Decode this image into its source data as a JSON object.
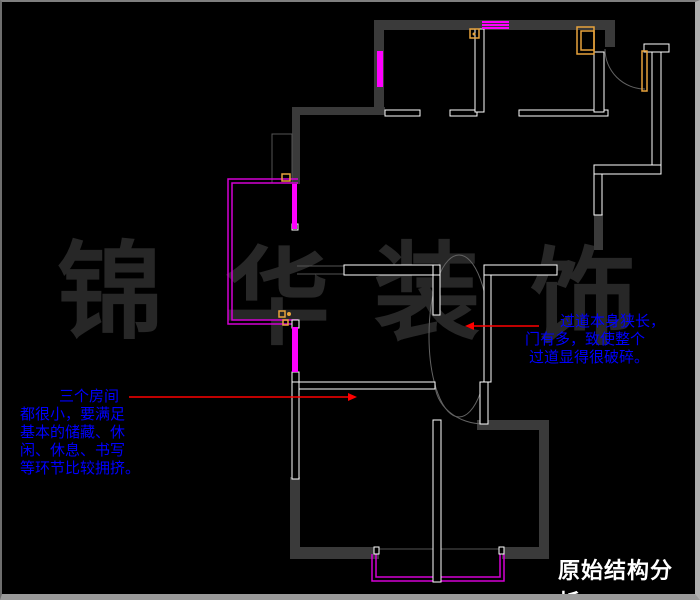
{
  "title": "原始结构分析",
  "watermark": {
    "chars": [
      "锦",
      "华",
      "装",
      "饰"
    ]
  },
  "annotations": {
    "left": {
      "lines": [
        "三个房间",
        "都很小，要满足",
        "基本的储藏、休",
        "闲、休息、书写",
        "等环节比较拥挤。"
      ]
    },
    "right": {
      "lines": [
        "过道本身狭长，",
        "门有多，致使整个",
        "过道显得很破碎。"
      ]
    }
  },
  "colors": {
    "background": "#000000",
    "wall_dark": "#3a3a3a",
    "wall_white": "#ffffff",
    "line_gray": "#555555",
    "arc_gray": "#636363",
    "window_magenta": "#ff00ff",
    "outline_magenta": "#d400d4",
    "fixture_orange": "#e8a33c",
    "leader_red": "#ff0000",
    "annotation_blue": "#0000ff",
    "title_white": "#ffffff",
    "watermark_gray": "#272727"
  },
  "floor_plan": {
    "dark_walls": [
      [
        372,
        18,
        241,
        10
      ],
      [
        372,
        18,
        10,
        95
      ],
      [
        290,
        105,
        93,
        8
      ],
      [
        290,
        105,
        8,
        77
      ],
      [
        603,
        28,
        10,
        17
      ],
      [
        592,
        212,
        9,
        36
      ],
      [
        288,
        475,
        10,
        80
      ],
      [
        288,
        545,
        89,
        12
      ],
      [
        475,
        418,
        72,
        10
      ],
      [
        537,
        418,
        10,
        134
      ],
      [
        500,
        545,
        47,
        12
      ]
    ],
    "white_walls": [
      [
        383,
        108,
        35,
        6
      ],
      [
        448,
        108,
        27,
        6
      ],
      [
        473,
        27,
        9,
        83
      ],
      [
        517,
        108,
        89,
        6
      ],
      [
        592,
        50,
        10,
        60
      ],
      [
        642,
        42,
        25,
        8
      ],
      [
        650,
        50,
        9,
        113
      ],
      [
        592,
        163,
        67,
        9
      ],
      [
        592,
        172,
        8,
        41
      ],
      [
        342,
        263,
        91,
        10
      ],
      [
        431,
        263,
        7,
        19
      ],
      [
        482,
        263,
        73,
        10
      ],
      [
        431,
        273,
        7,
        40
      ],
      [
        482,
        273,
        7,
        107
      ],
      [
        478,
        380,
        8,
        42
      ],
      [
        297,
        380,
        136,
        7
      ],
      [
        290,
        380,
        7,
        97
      ],
      [
        290,
        318,
        7,
        8
      ],
      [
        290,
        370,
        7,
        10
      ],
      [
        431,
        418,
        8,
        162
      ],
      [
        290,
        222,
        6,
        6
      ],
      [
        372,
        545,
        5,
        7
      ],
      [
        497,
        545,
        5,
        7
      ]
    ],
    "gray_rects": [
      [
        270,
        132,
        20,
        49
      ]
    ],
    "gray_lines": [
      [
        295,
        264,
        342,
        264
      ],
      [
        295,
        272,
        342,
        272
      ],
      [
        375,
        547,
        497,
        547
      ]
    ],
    "magenta_bars": [
      [
        375,
        49,
        6,
        36
      ],
      [
        290,
        182,
        5,
        45
      ],
      [
        290,
        325,
        6,
        45
      ],
      [
        480,
        19,
        27,
        2
      ],
      [
        480,
        22,
        27,
        2
      ],
      [
        480,
        25,
        27,
        2
      ]
    ],
    "magenta_paths": [
      "M296 177 H226 V322 H296",
      "M296 181 H230 V318 H296",
      "M370 552 V579 H502 V552",
      "M374 552 V575 H498 V552"
    ],
    "door_arcs": [
      "M603 47 A40 40 0 0 0 643 87",
      "M433 381 A49 41 0 0 0 482 422"
    ],
    "passage_ellipse": {
      "cx": 457,
      "cy": 334,
      "rx": 30,
      "ry": 81
    },
    "orange_rects": [
      [
        468,
        27,
        9,
        9
      ],
      [
        575,
        25,
        17,
        27
      ],
      [
        579,
        29,
        13,
        19
      ],
      [
        640,
        49,
        5,
        40
      ],
      [
        280,
        172,
        8,
        7
      ],
      [
        277,
        309,
        6,
        6
      ],
      [
        281,
        318,
        5,
        5
      ]
    ],
    "orange_circles": [
      [
        472,
        32,
        1.5
      ],
      [
        287,
        312,
        2
      ]
    ],
    "leaders": [
      {
        "x1": 127,
        "y1": 395,
        "x2": 346,
        "y2": 395,
        "head": "e"
      },
      {
        "x1": 472,
        "y1": 324,
        "x2": 537,
        "y2": 324,
        "head": "w"
      }
    ]
  }
}
